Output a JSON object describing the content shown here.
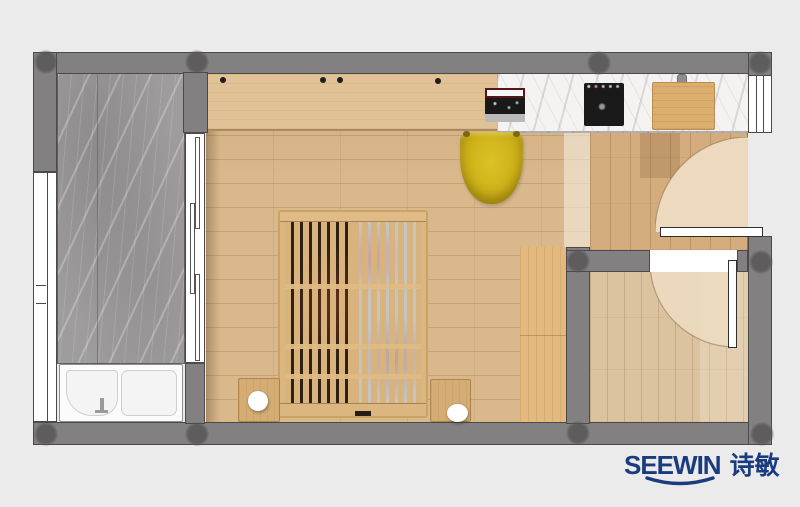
{
  "brand": {
    "wordmark": "SEEWIN",
    "wordmark_cn": "诗敏",
    "color": "#1b3b80"
  },
  "palette": {
    "background": "#ecebeb",
    "wall": "#828080",
    "wall_outline": "#4a4a4a",
    "column": "#6c6a6a",
    "floor_wood_pale": "#d9b88c",
    "floor_wood_hall": "#d4ac7e",
    "floor_wood_strip": "#e3b97f",
    "floor_wood_small_room": "#dcc3a0",
    "marble_balcony": "#9f9c9d",
    "marble_counter": "#f4f3f1",
    "door_swing_area": "#eedcc2",
    "door_leaf": "#ffffff",
    "bed_wood": "#dcb67f",
    "bed_gap_dark": "#2f2012",
    "chair_yellow": "#cdb118",
    "cooktop_black": "#1a1a1a",
    "cutting_board": "#dcae6e",
    "bathtub_white": "#fbfbfb",
    "lamp_white": "#ffffff"
  },
  "plan": {
    "rooms": [
      "balcony",
      "main-room",
      "entry-hall",
      "kitchenette-counter",
      "side-room"
    ],
    "furniture": [
      "desk",
      "laptop",
      "desk-chair",
      "induction-cooktop",
      "cutting-board",
      "slatted-bed",
      "nightstand-left",
      "table-lamp-left",
      "nightstand-right",
      "table-lamp-right",
      "bathtub",
      "sliding-door",
      "entry-door",
      "side-room-door"
    ]
  }
}
